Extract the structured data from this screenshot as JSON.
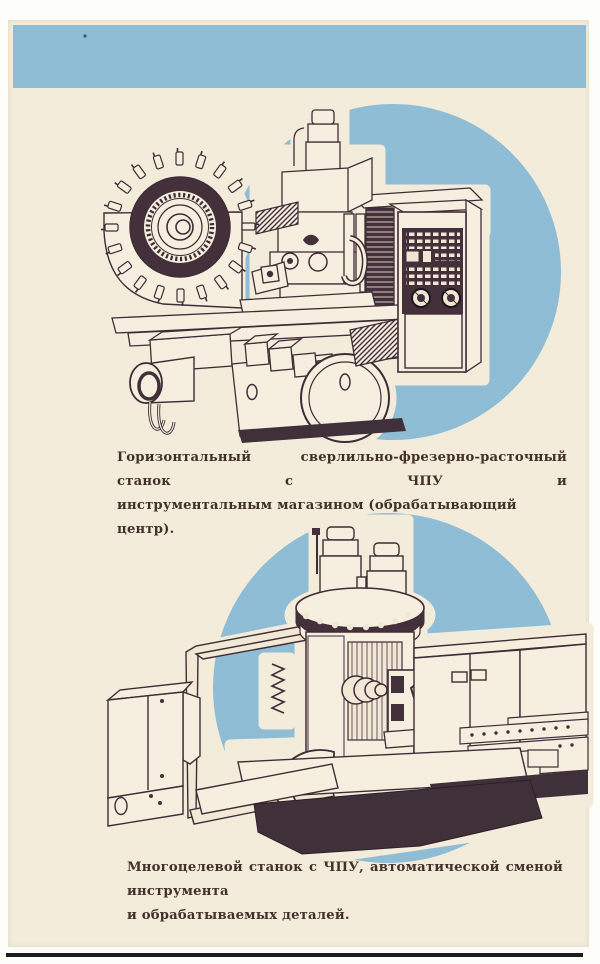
{
  "page": {
    "paper_color": "#f4ecda",
    "accent_blue": "#8fbdd6",
    "ink_color": "#43302a",
    "figures": [
      {
        "caption_line1": "Горизонтальный сверлильно-фрезерно-расточный станок с ЧПУ и",
        "caption_line2": "инструментальным магазином (обрабатывающий центр)."
      },
      {
        "caption_line1": "Многоцелевой станок с ЧПУ, автоматической сменой инструмента",
        "caption_line2": "и обрабатываемых деталей."
      }
    ]
  }
}
